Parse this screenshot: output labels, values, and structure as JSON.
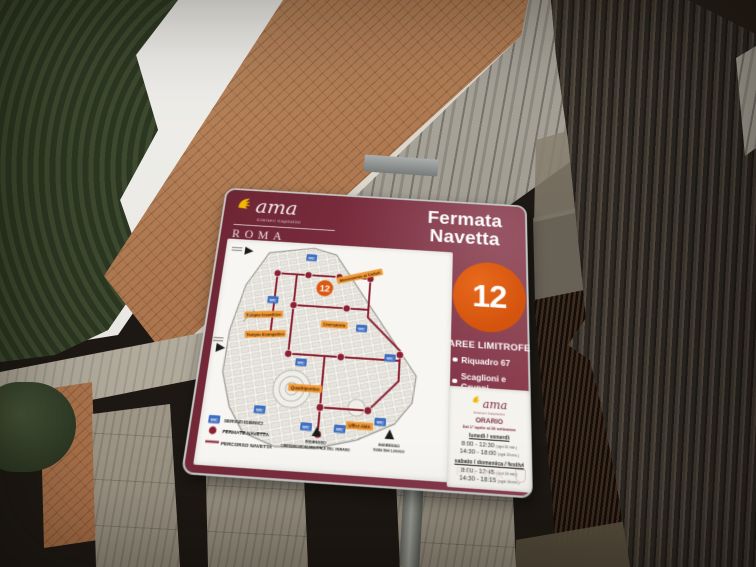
{
  "sign": {
    "brand": {
      "name": "ama",
      "subtitle": "Cimiteri Capitolini",
      "city": "ROMA"
    },
    "title": {
      "line1": "Fermata",
      "line2": "Navetta"
    },
    "stop_number": "12",
    "aree": {
      "heading": "AREE LIMITROFE",
      "items": [
        "Riquadro 67",
        "Scaglioni e Gruppi"
      ]
    },
    "map": {
      "wc": "WC",
      "legend": [
        {
          "icon": "wc-badge",
          "label": "SERVIZI IGIENICI"
        },
        {
          "icon": "stop-dot",
          "label": "FERMATE NAVETTA"
        },
        {
          "icon": "route-line",
          "label": "PERCORSO NAVETTA"
        }
      ],
      "labels": [
        "Monumento ai Caduti",
        "Crematorio",
        "Tempio Israelitico",
        "Tempio Evangelico",
        "Quadriportico",
        "Uffici AMA"
      ],
      "entrances": [
        {
          "title": "INGRESSO",
          "name": "CIMITERO MONUMENTALE DEL VERANO"
        },
        {
          "title": "INGRESSO",
          "name": "Scala San Lorenzo"
        }
      ]
    },
    "schedule": {
      "heading": "ORARIO",
      "subheading": "Dal 1° aprile al 30 settembre",
      "blocks": [
        {
          "days": "lunedì / venerdì",
          "times": [
            {
              "range": "8:00 - 12:30",
              "note": "(ogni 30 min.)"
            },
            {
              "range": "14:30 - 18:00",
              "note": "(ogni 30 min.)"
            }
          ]
        },
        {
          "days": "sabato / domenica / festivi",
          "times": [
            {
              "range": "8:00 - 12:45",
              "note": "(ogni 15 min.)"
            },
            {
              "range": "14:30 - 18:15",
              "note": "(ogni 15 min.)"
            }
          ]
        }
      ],
      "footer_city": "ROMA"
    },
    "colors": {
      "board_maroon": "#7b2d3e",
      "stop_badge_orange": "#d95a10",
      "route_red": "#8c2032",
      "map_label_orange": "#f09a38",
      "wc_blue": "#3f6fc0",
      "brand_yellow": "#f2b705"
    }
  }
}
